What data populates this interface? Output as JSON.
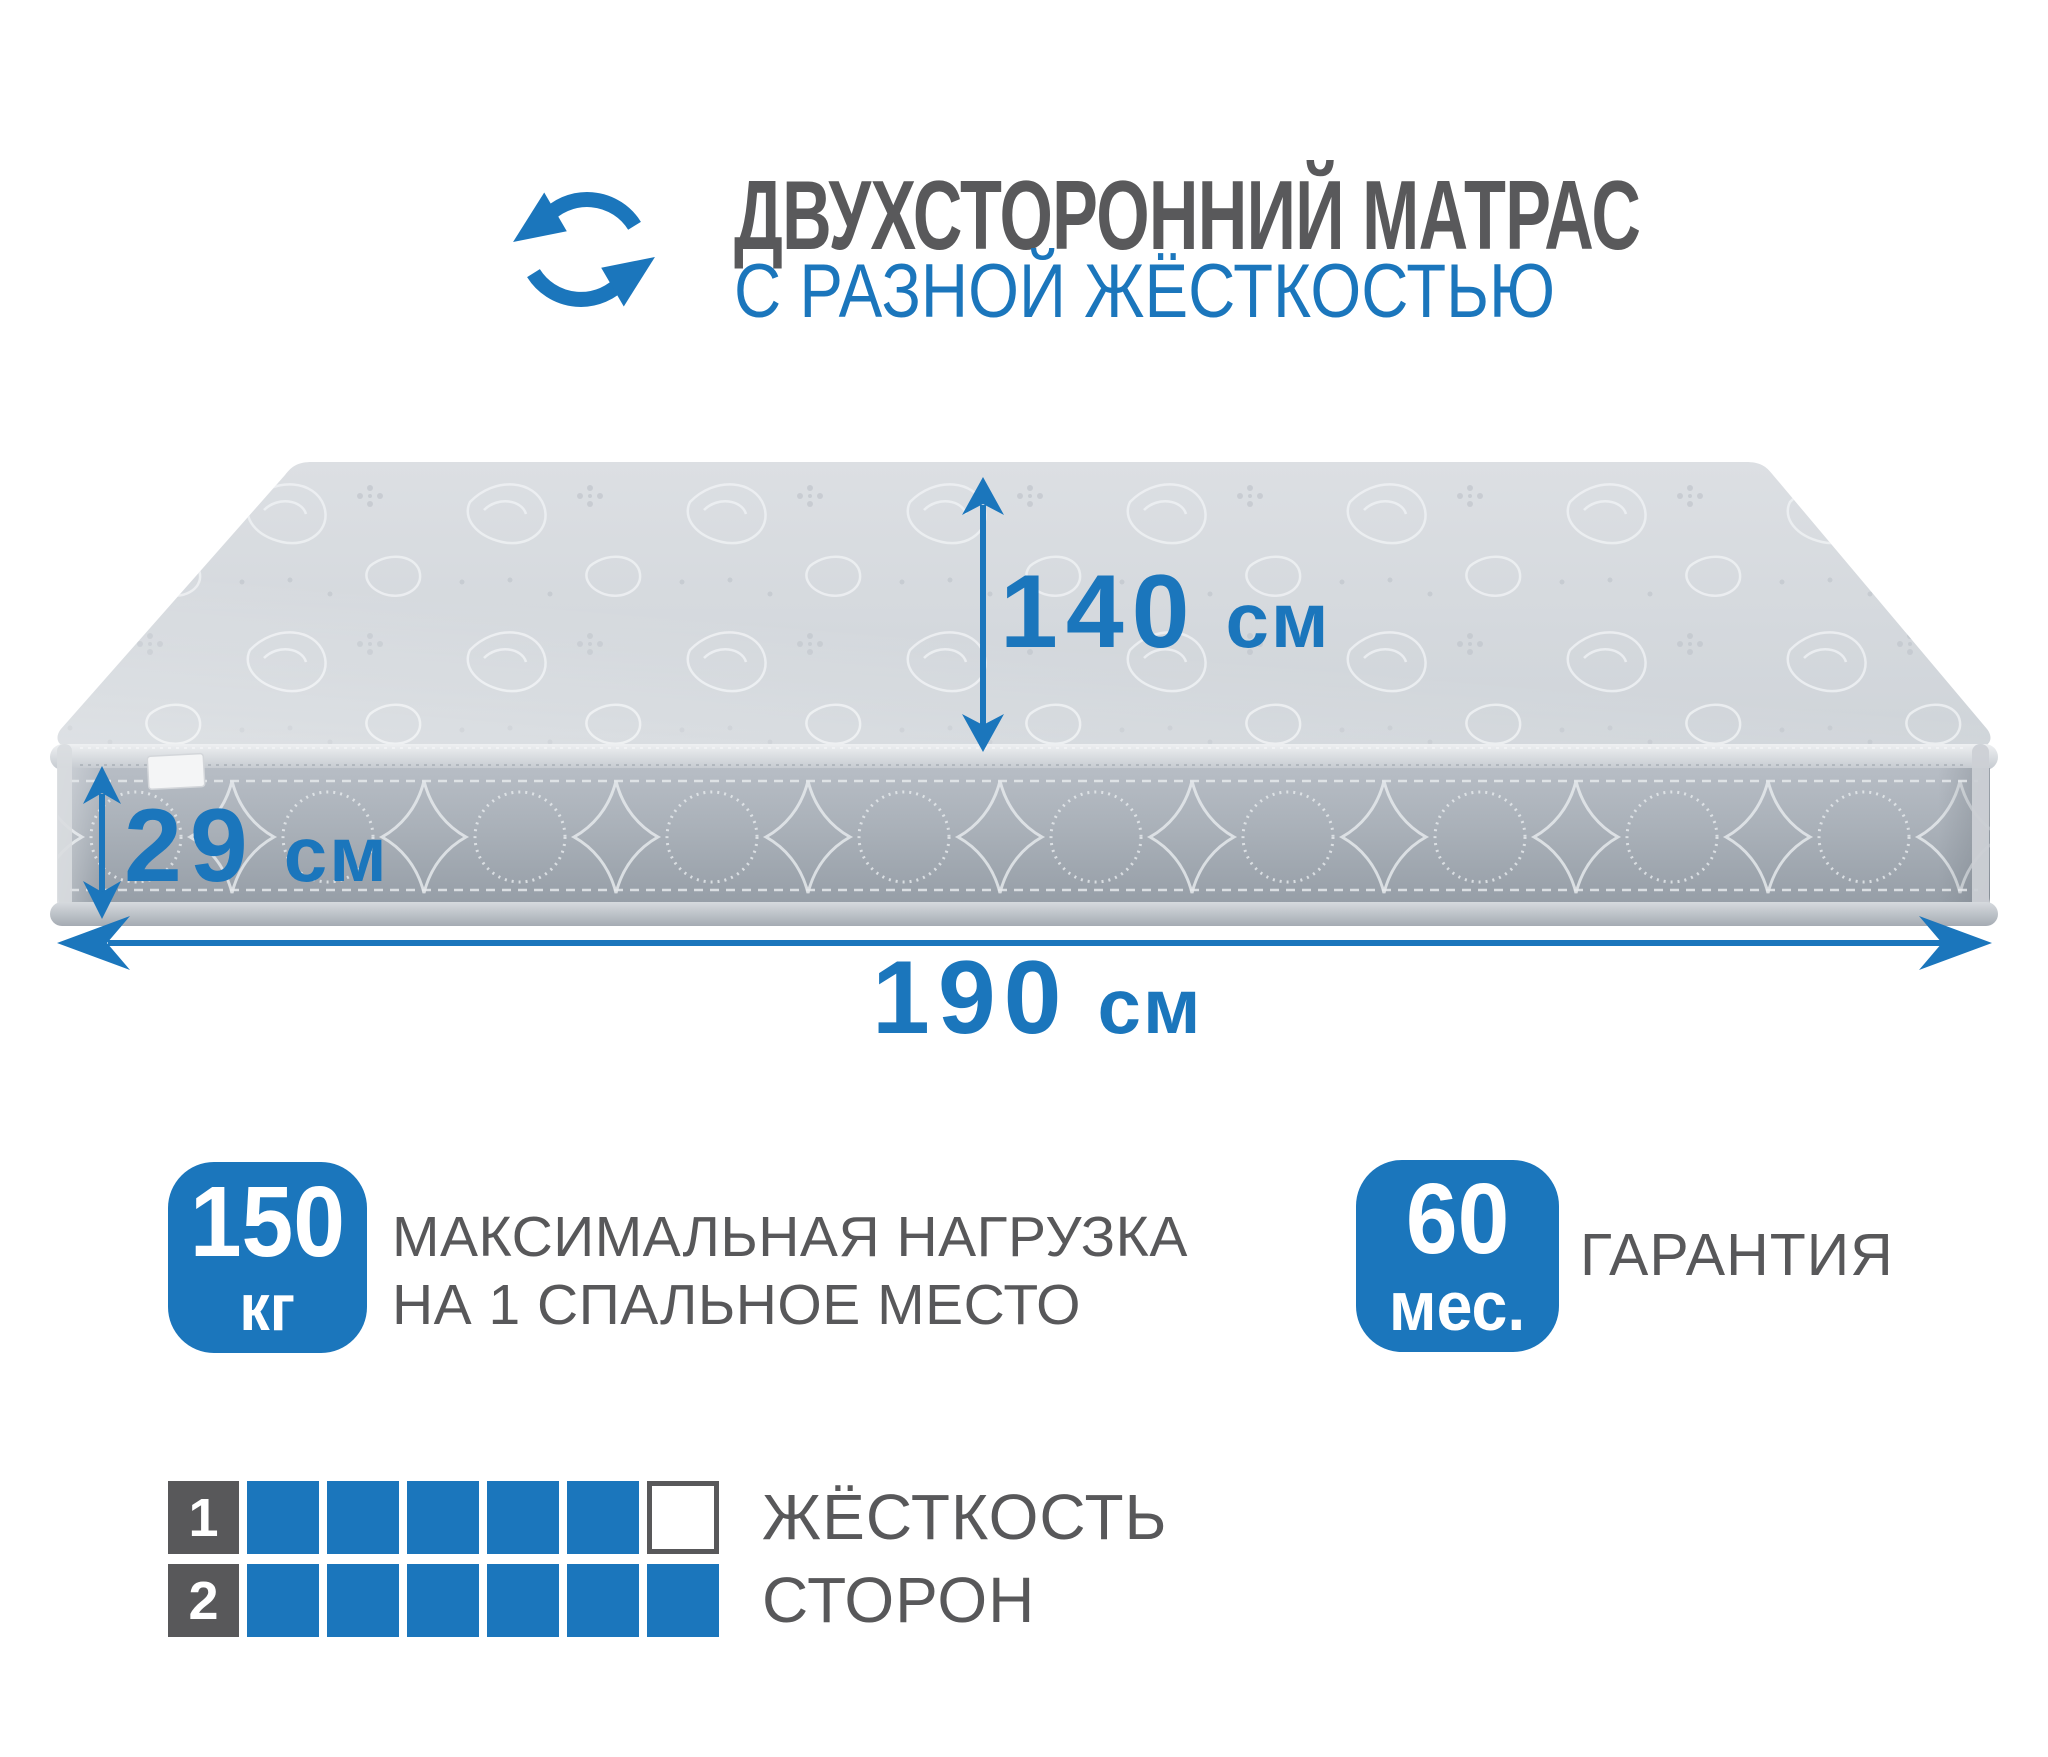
{
  "header": {
    "title": "ДВУХСТОРОННИЙ МАТРАС",
    "subtitle": "С РАЗНОЙ ЖЁСТКОСТЬЮ",
    "icon": "rotate-arrows-icon"
  },
  "dimensions": {
    "width": {
      "value": "140",
      "unit": "см"
    },
    "height": {
      "value": "29",
      "unit": "см"
    },
    "length": {
      "value": "190",
      "unit": "см"
    }
  },
  "features": {
    "max_load": {
      "badge_value": "150",
      "badge_unit": "кг",
      "label_line1": "МАКСИМАЛЬНАЯ НАГРУЗКА",
      "label_line2": "НА 1 СПАЛЬНОЕ МЕСТО"
    },
    "warranty": {
      "badge_value": "60",
      "badge_unit": "мес.",
      "label": "ГАРАНТИЯ"
    }
  },
  "hardness": {
    "label_line1": "ЖЁСТКОСТЬ",
    "label_line2": "СТОРОН",
    "rows": [
      {
        "label": "1",
        "filled": 5,
        "total": 6
      },
      {
        "label": "2",
        "filled": 6,
        "total": 6
      }
    ]
  },
  "colors": {
    "accent_blue": "#1b76bc",
    "text_gray": "#58585a",
    "mattress_top": "#d5d9dd",
    "mattress_side": "#a9b0b8"
  }
}
